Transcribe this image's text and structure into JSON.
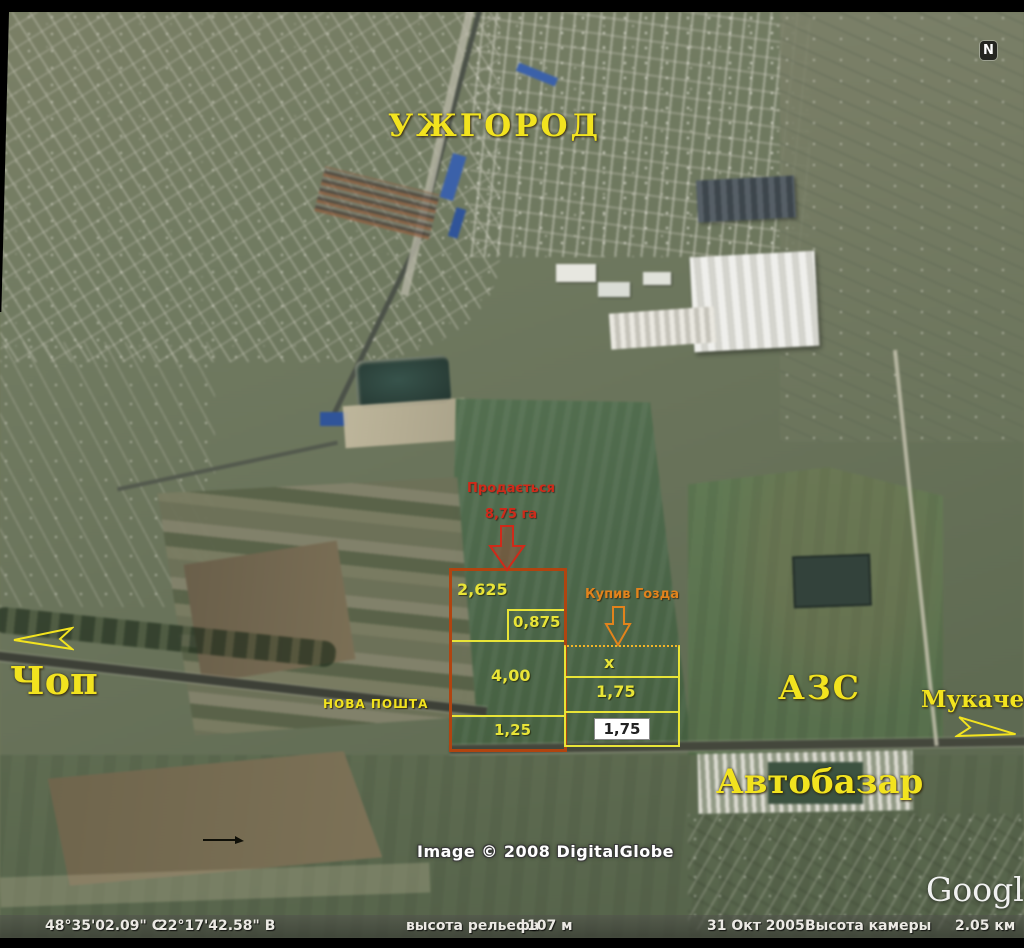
{
  "map": {
    "city": "УЖГОРОД",
    "towns": {
      "chop": "Чоп",
      "mukachevo": "Мукачево"
    },
    "pois": {
      "azs": "АЗС",
      "avtobazar": "Автобазар",
      "nova_poshta": "НОВА ПОШТА"
    },
    "sale": {
      "title": "Продається",
      "area": "8,75 га"
    },
    "buyer": {
      "label": "Купив Гозда"
    },
    "plots": {
      "left": {
        "p1": "2,625",
        "p2": "0,875",
        "p3": "4,00",
        "p4": "1,25"
      },
      "right": {
        "p1": "x",
        "p2": "1,75",
        "p3": "1,75"
      }
    },
    "north": "N",
    "credits": {
      "imagery": "Image © 2008 DigitalGlobe",
      "brand": "Google"
    }
  },
  "status_bar": {
    "lat": "48°35'02.09\" С",
    "lon": "22°17'42.58\" В",
    "terrain_label": "высота рельефа",
    "terrain_value": "107 м",
    "date": "31 Окт 2005",
    "camera_label": "Высота камеры",
    "camera_value": "2.05 км"
  },
  "colors": {
    "annotation_yellow": "#f2e31f",
    "sale_red": "#cf2a1a",
    "buyer_orange": "#e2831c",
    "plot_red": "#b04410",
    "plot_yellow": "#e8e437"
  }
}
